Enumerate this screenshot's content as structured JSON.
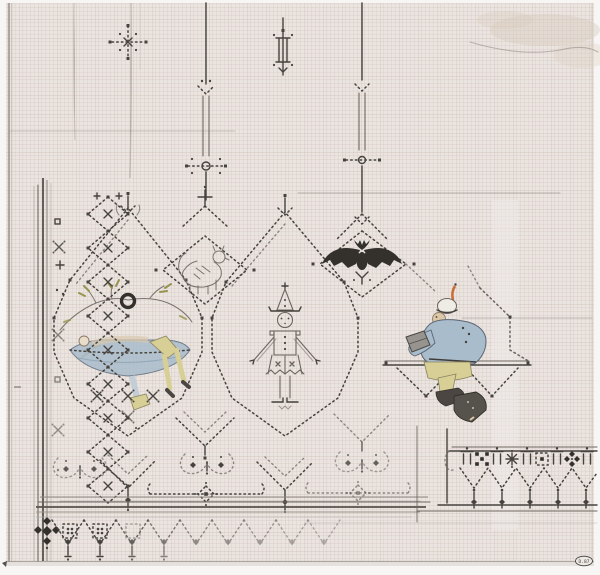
{
  "artwork": {
    "description": "Hand-drawn cross-stitch embroidery pattern on graph paper, partially colored",
    "stamp_text": "D.87",
    "paper": {
      "background": "#eae5e1",
      "grid_minor": "#cbb0a6",
      "grid_major": "#b89a8e",
      "margin": "#f7f6f5",
      "stain": "#d8cabb"
    },
    "palette": {
      "pencil": "#6e6660",
      "pencil_dark": "#46423d",
      "ink": "#34302c",
      "blue": "#a9bccb",
      "pale_blue": "#c3cdd6",
      "yellow": "#d7cf95",
      "olive": "#97944f",
      "orange": "#c86f38",
      "skin": "#dcc7a7",
      "gray_book": "#97948f",
      "shoe": "#4b4641"
    },
    "motifs": [
      "star-cross spot motif",
      "obelisk finial spot motif",
      "hanging pendant ornaments",
      "ogee lattice with gable finials",
      "lion in dotted diamond",
      "bat in dotted diamond",
      "figure reclining in hammock beneath branch and ring",
      "standing jester figure",
      "seated reader on bench with trusses",
      "scroll ornaments and pendant drops",
      "fringed bottom border",
      "diamond-chain left border",
      "detached border sample strip"
    ]
  }
}
